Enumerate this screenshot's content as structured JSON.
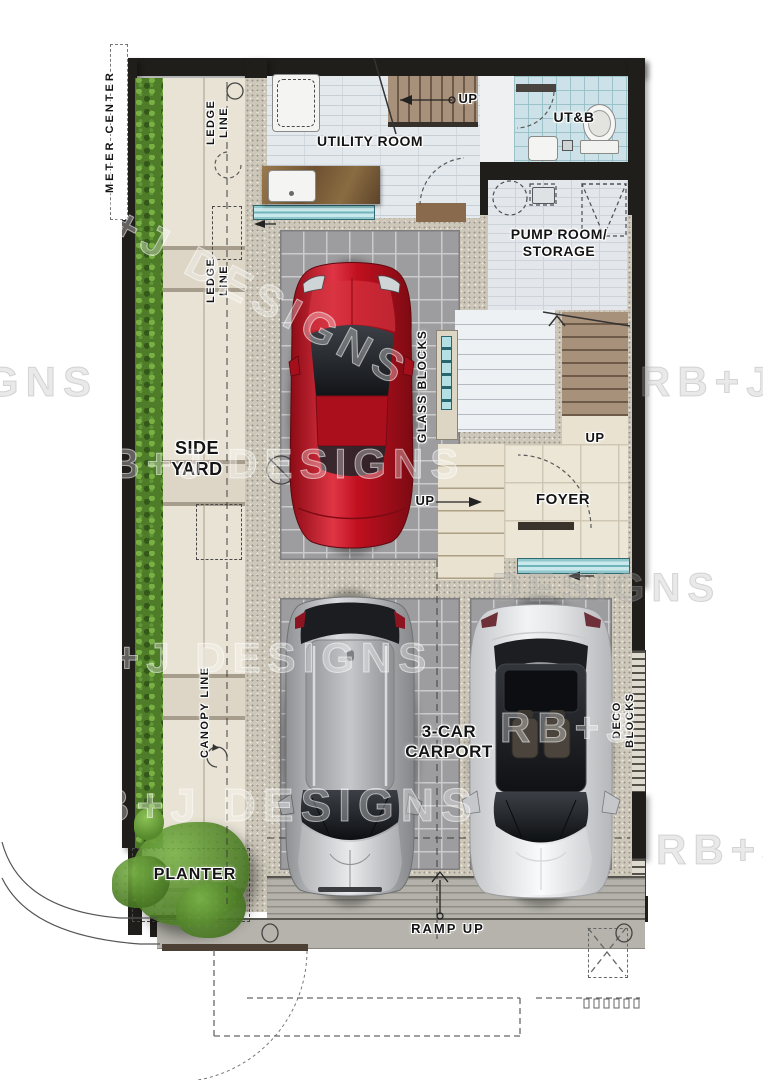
{
  "title": "Residential ground floor plan with 3-car carport",
  "colors": {
    "wall": "#201e1b",
    "window_teal": "#8fc7cd",
    "carport_tile": "#9d9d9f",
    "paver": "#e8e3d5",
    "hedge_green": "#4e7c28",
    "red_car": "#c01020",
    "silver_suv": "#b9bbbd",
    "white_sedan": "#e9eaec"
  },
  "labels": {
    "meter_center": "METER CENTER",
    "ledge_line": "LEDGE LINE",
    "canopy_line": "CANOPY LINE",
    "side_yard": "SIDE YARD",
    "utility_room": "UTILITY ROOM",
    "utb": "UT&B",
    "pump_room": "PUMP ROOM/ STORAGE",
    "glass_blocks": "GLASS BLOCKS",
    "foyer": "FOYER",
    "up": "UP",
    "carport": "3-CAR CARPORT",
    "deco_blocks": "DECO BLOCKS",
    "planter": "PLANTER",
    "ramp_up": "RAMP UP"
  },
  "cars": [
    {
      "name": "red-sports-car",
      "color": "#c01020"
    },
    {
      "name": "silver-suv",
      "color": "#b9bbbd"
    },
    {
      "name": "white-sedan",
      "color": "#e9eaec"
    }
  ],
  "watermarks": {
    "brand": "RB+J DESIGNS",
    "fragments": [
      {
        "text": "RB+J DESIGNS"
      },
      {
        "text": "GNS"
      },
      {
        "text": "RB+J DE"
      },
      {
        "text": "RB+J DESIGNS"
      },
      {
        "text": "DESIGNS"
      },
      {
        "text": "RB+J DE"
      },
      {
        "text": "RB+J DESIGNS"
      },
      {
        "text": "RB+J DESIGNS"
      },
      {
        "text": "RB+J"
      }
    ]
  }
}
